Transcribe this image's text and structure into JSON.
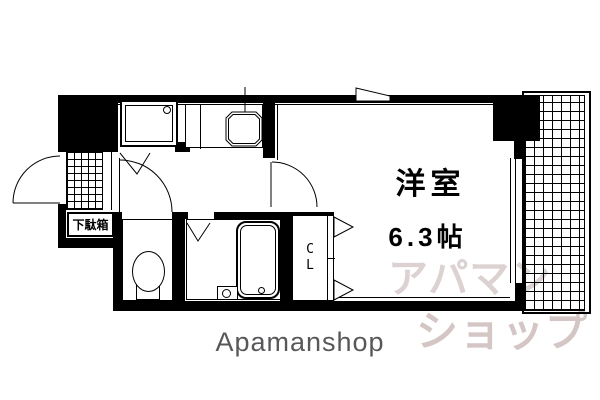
{
  "floor_plan": {
    "room": {
      "name": "洋室",
      "size": "6.3帖"
    },
    "entrance": {
      "shoe_box_label": "下駄箱"
    },
    "closet": {
      "letter_top": "C",
      "letter_bottom": "L"
    },
    "colors": {
      "wall": "#000000",
      "floor": "#ffffff",
      "watermark_top": "#ddd2d2",
      "watermark_bottom": "#d5c6c6",
      "brand_text": "#58585b"
    }
  },
  "watermark": {
    "line1": "アパマン",
    "line2": "ショップ"
  },
  "footer": {
    "brand": "Apamanshop"
  }
}
